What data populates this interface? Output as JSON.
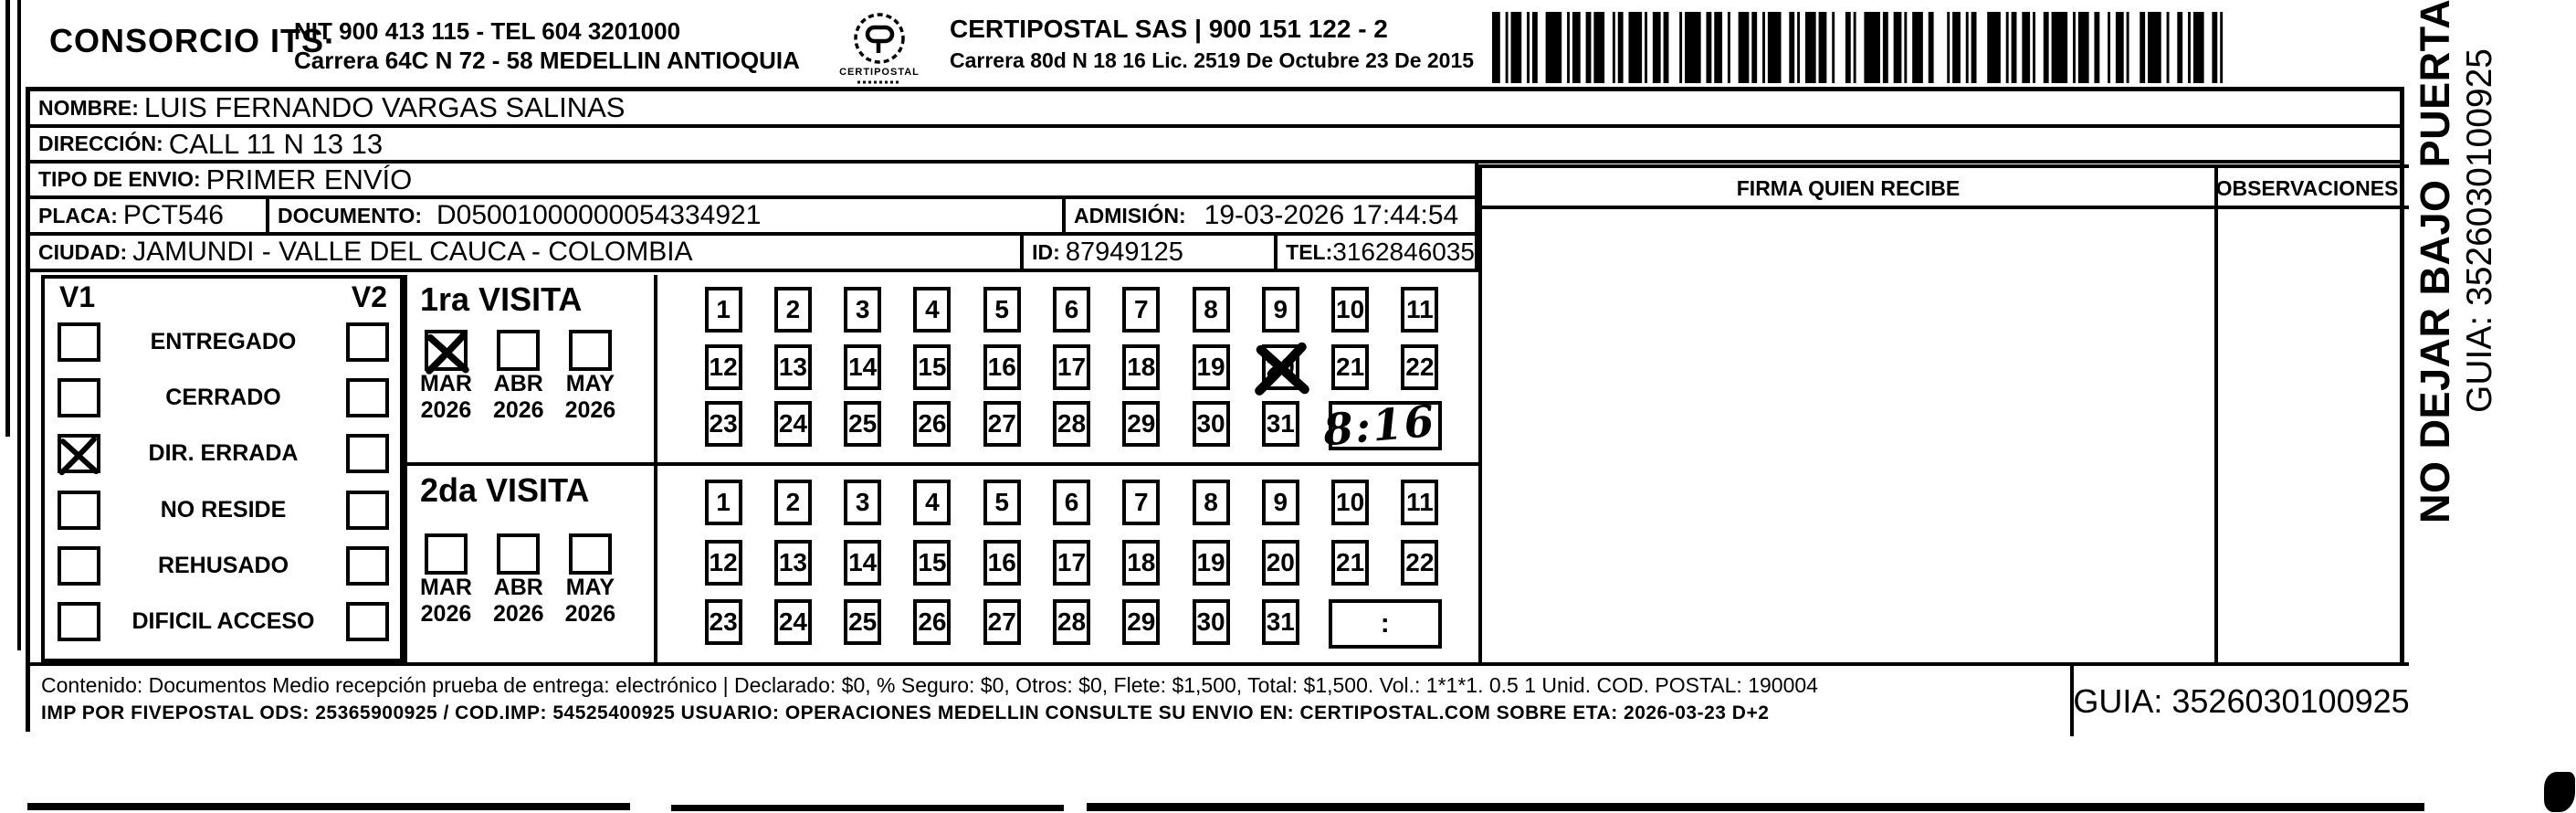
{
  "header": {
    "company": "CONSORCIO ITS·",
    "nit_line1": "NIT 900 413 115 - TEL 604 3201000",
    "nit_line2": "Carrera 64C N 72 - 58 MEDELLIN ANTIOQUIA",
    "logo_name": "CERTIPOSTAL",
    "certipostal_line1": "CERTIPOSTAL SAS | 900 151 122 - 2",
    "certipostal_line2": "Carrera 80d N 18 16  Lic. 2519 De Octubre 23 De 2015"
  },
  "fields": {
    "nombre_label": "NOMBRE:",
    "nombre": "LUIS FERNANDO VARGAS SALINAS",
    "direccion_label": "DIRECCIÓN:",
    "direccion": "CALL 11 N 13 13",
    "tipo_envio_label": "TIPO DE ENVIO:",
    "tipo_envio": "PRIMER ENVÍO",
    "placa_label": "PLACA:",
    "placa": "PCT546",
    "documento_label": "DOCUMENTO:",
    "documento": "D05001000000054334921",
    "admision_label": "ADMISIÓN:",
    "admision": "19-03-2026 17:44:54",
    "ciudad_label": "CIUDAD:",
    "ciudad": "JAMUNDI - VALLE DEL CAUCA - COLOMBIA",
    "id_label": "ID:",
    "id_value": "87949125",
    "tel_label": "TEL:",
    "tel": "3162846035"
  },
  "signature_panel": {
    "firma_header": "FIRMA QUIEN RECIBE",
    "observaciones_header": "OBSERVACIONES"
  },
  "status_panel": {
    "col1_header": "V1",
    "col2_header": "V2",
    "items": [
      {
        "label": "ENTREGADO",
        "v1_checked": false,
        "v2_checked": false
      },
      {
        "label": "CERRADO",
        "v1_checked": false,
        "v2_checked": false
      },
      {
        "label": "DIR. ERRADA",
        "v1_checked": true,
        "v2_checked": false
      },
      {
        "label": "NO RESIDE",
        "v1_checked": false,
        "v2_checked": false
      },
      {
        "label": "REHUSADO",
        "v1_checked": false,
        "v2_checked": false
      },
      {
        "label": "DIFICIL ACCESO",
        "v1_checked": false,
        "v2_checked": false
      }
    ]
  },
  "visits": {
    "day_numbers": [
      1,
      2,
      3,
      4,
      5,
      6,
      7,
      8,
      9,
      10,
      11,
      12,
      13,
      14,
      15,
      16,
      17,
      18,
      19,
      20,
      21,
      22,
      23,
      24,
      25,
      26,
      27,
      28,
      29,
      30,
      31
    ],
    "time_box_separator": ":",
    "first": {
      "title": "1ra VISITA",
      "months": [
        {
          "month": "MAR",
          "year": "2026",
          "checked": true
        },
        {
          "month": "ABR",
          "year": "2026",
          "checked": false
        },
        {
          "month": "MAY",
          "year": "2026",
          "checked": false
        }
      ],
      "marked_day": 20,
      "time_written": "8:16"
    },
    "second": {
      "title": "2da VISITA",
      "months": [
        {
          "month": "MAR",
          "year": "2026",
          "checked": false
        },
        {
          "month": "ABR",
          "year": "2026",
          "checked": false
        },
        {
          "month": "MAY",
          "year": "2026",
          "checked": false
        }
      ],
      "marked_day": null,
      "time_written": ""
    }
  },
  "footer": {
    "line1": "Contenido: Documentos Medio recepción prueba de entrega: electrónico | Declarado: $0, % Seguro: $0, Otros: $0, Flete: $1,500, Total: $1,500. Vol.: 1*1*1. 0.5  1 Unid. COD. POSTAL: 190004",
    "line2": "IMP POR FIVEPOSTAL ODS: 25365900925 / COD.IMP: 54525400925 USUARIO: OPERACIONES MEDELLIN CONSULTE SU ENVIO EN: CERTIPOSTAL.COM SOBRE ETA: 2026-03-23 D+2",
    "guia": "GUIA: 3526030100925"
  },
  "side_note": {
    "warning": "NO DEJAR BAJO PUERTA",
    "guia": "GUIA: 3526030100925"
  },
  "colors": {
    "ink": "#000000",
    "paper": "#ffffff"
  }
}
